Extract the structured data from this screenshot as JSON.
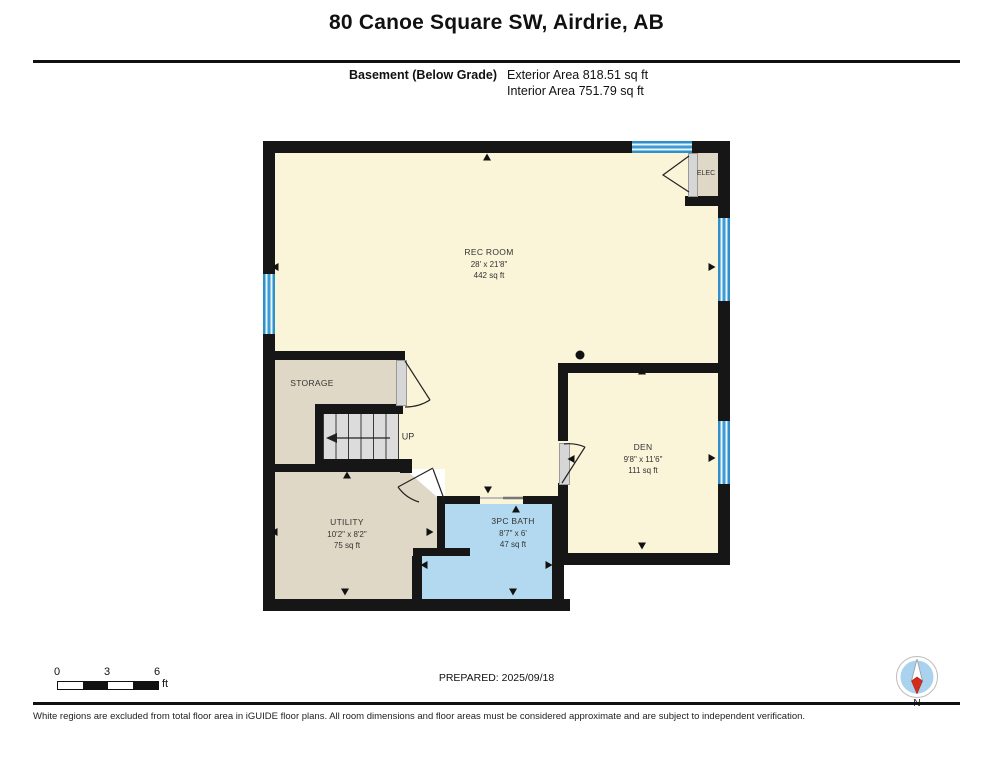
{
  "header": {
    "title": "80 Canoe Square SW, Airdrie, AB",
    "floor_label": "Basement (Below Grade)",
    "exterior_area": "Exterior Area 818.51 sq ft",
    "interior_area": "Interior Area 751.79 sq ft"
  },
  "rooms": {
    "rec": {
      "name": "REC ROOM",
      "dims": "28' x 21'8\"",
      "area": "442 sq ft"
    },
    "den": {
      "name": "DEN",
      "dims": "9'8\" x 11'6\"",
      "area": "111 sq ft"
    },
    "utility": {
      "name": "UTILITY",
      "dims": "10'2\" x 8'2\"",
      "area": "75 sq ft"
    },
    "bath": {
      "name": "3PC BATH",
      "dims": "8'7\" x 6'",
      "area": "47 sq ft"
    },
    "storage": {
      "name": "STORAGE"
    },
    "elec": {
      "name": "ELEC"
    },
    "stairs": {
      "label": "UP"
    }
  },
  "footer": {
    "scale": {
      "t0": "0",
      "t3": "3",
      "t6": "6",
      "unit": "ft"
    },
    "prepared": "PREPARED: 2025/09/18",
    "compass_label": "N",
    "disclaimer": "White regions are excluded from total floor area in iGUIDE floor plans. All room dimensions and floor areas must be considered approximate and are subject to independent verification."
  },
  "colors": {
    "wall": "#161616",
    "room_cream": "#FAF4D9",
    "room_tan": "#E0D8C6",
    "room_bath_blue": "#B3D9F0",
    "window_blue": "#3F9BD3",
    "compass_red": "#D42B1E",
    "compass_disc": "#A9D2EE"
  }
}
